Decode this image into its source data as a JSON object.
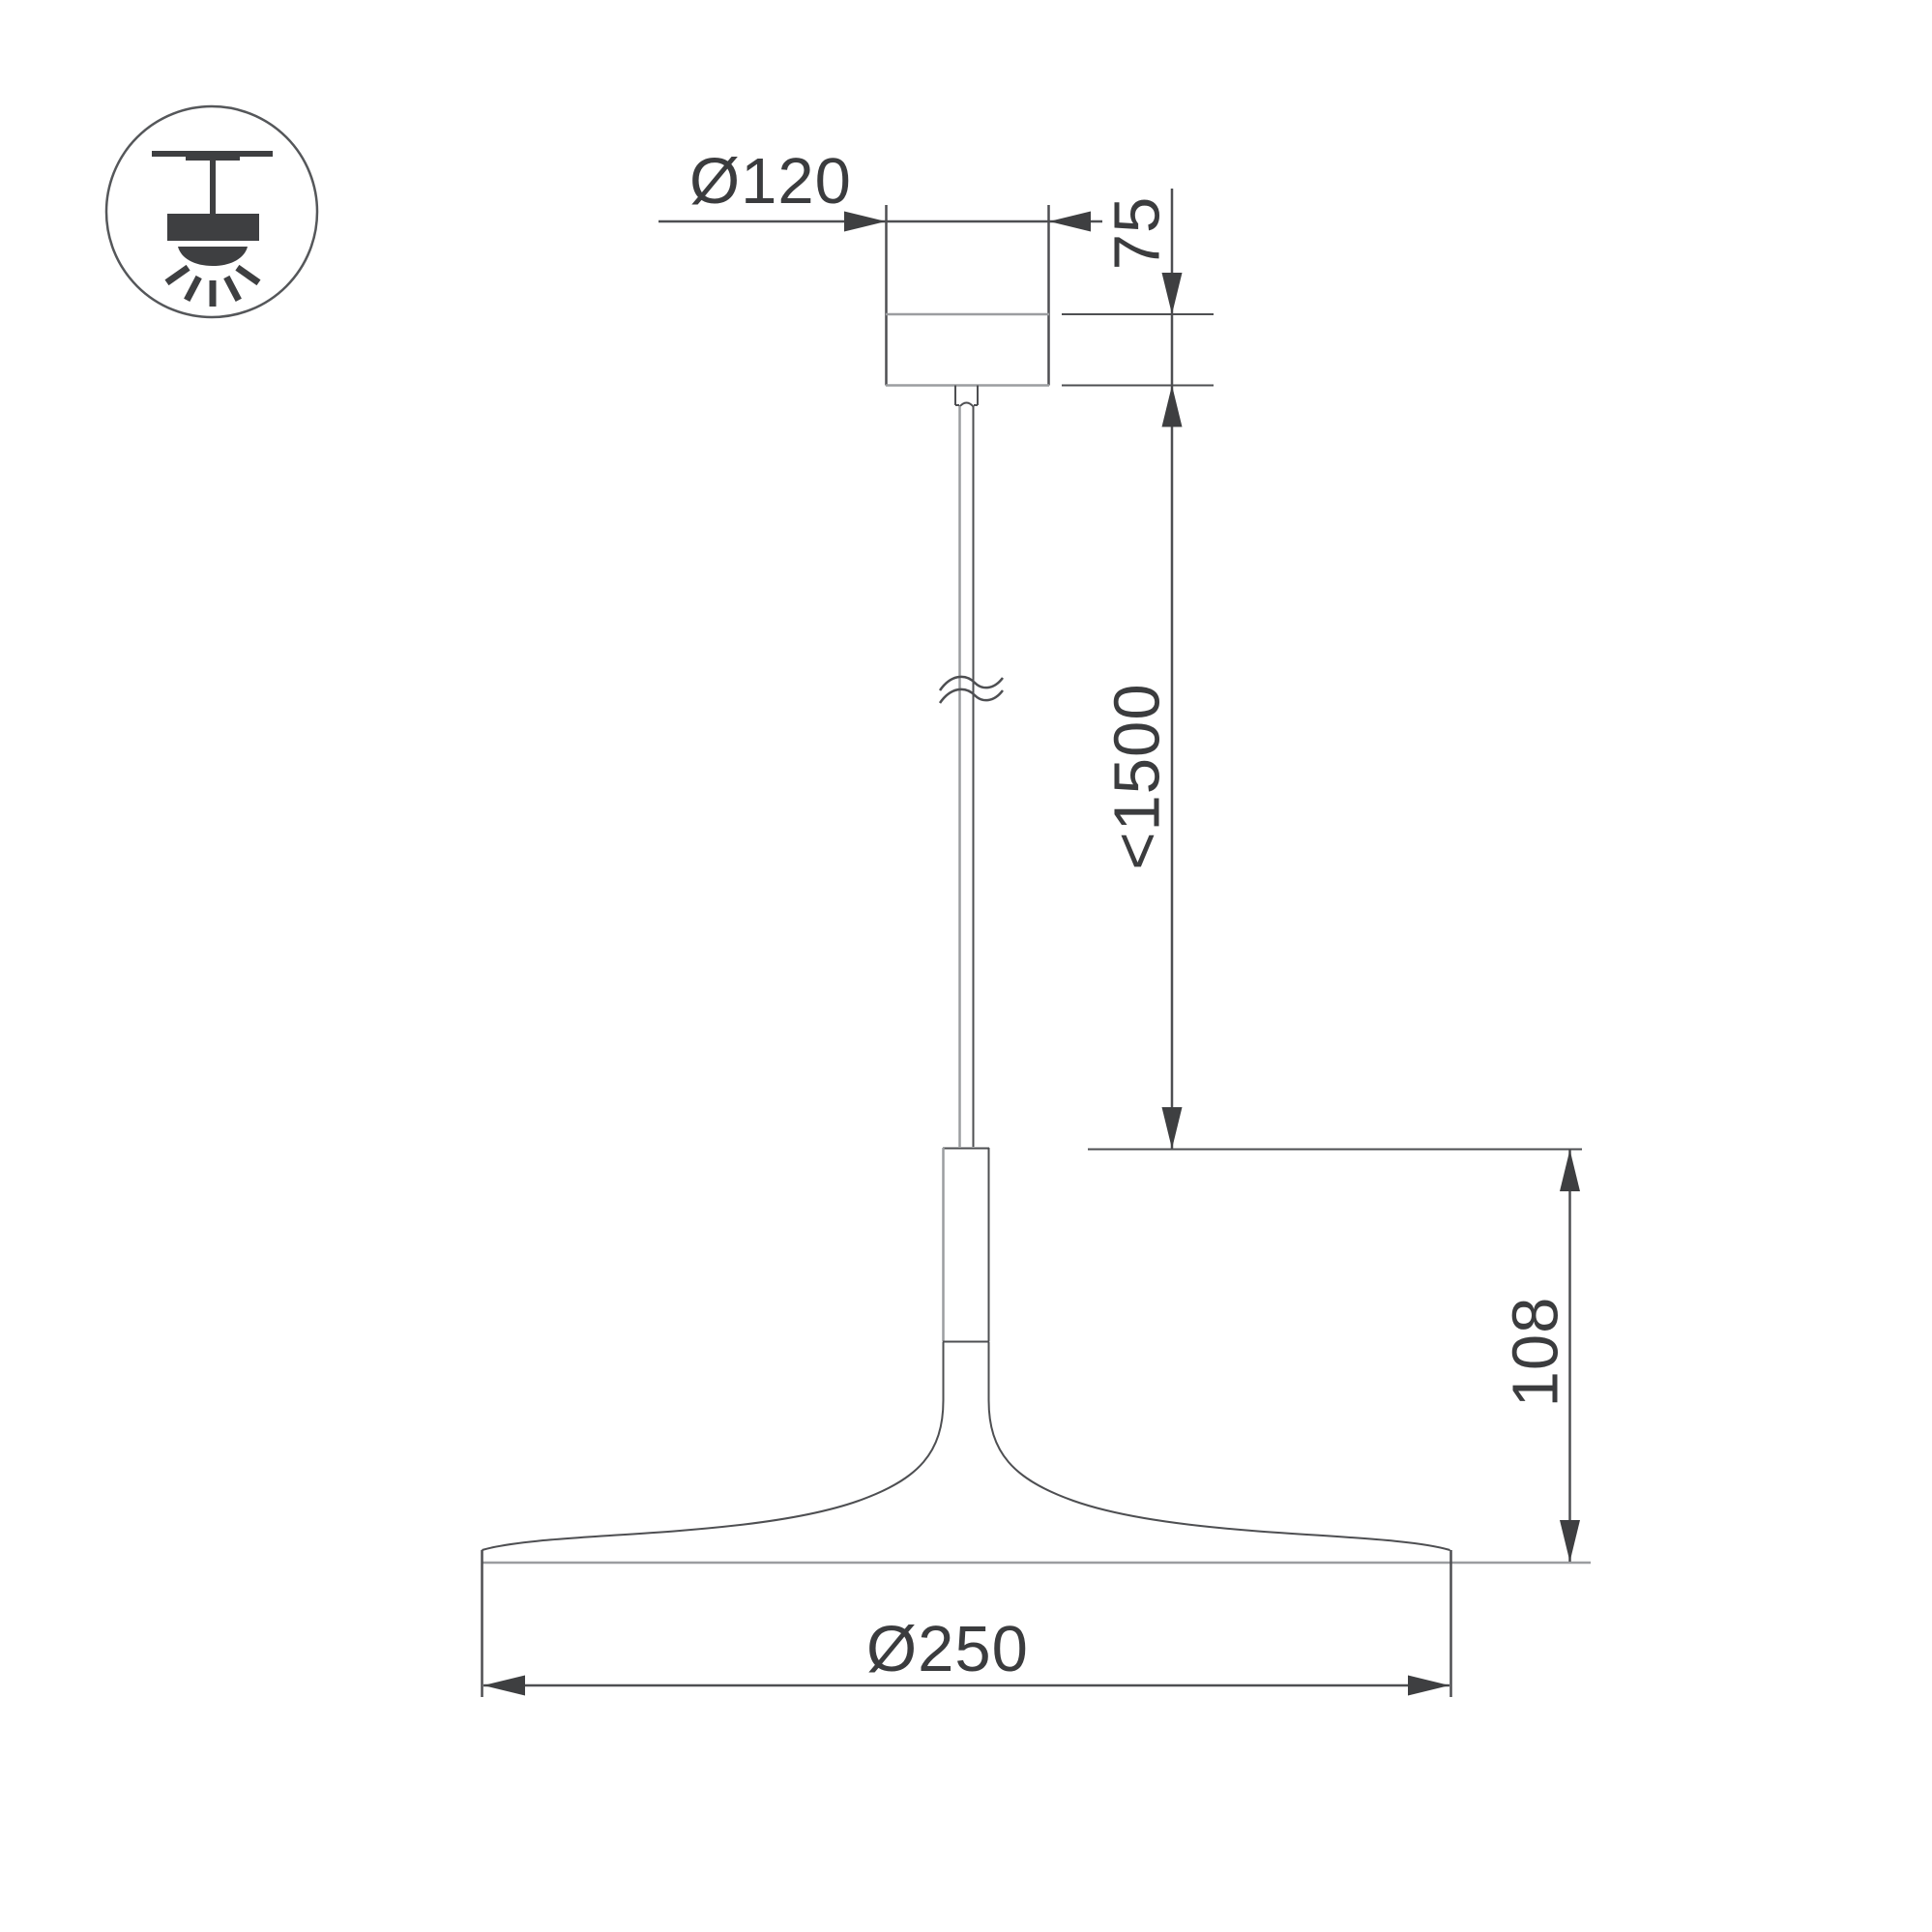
{
  "title": "Pendant luminaire dimension drawing",
  "colors": {
    "line_dark": "#4e4f52",
    "line_gray": "#9b9da0",
    "fill_dark": "#3e3f41",
    "text": "#3b3c3e",
    "bg": "#ffffff"
  },
  "icon": {
    "name": "ceiling-pendant-mount-icon"
  },
  "labels": {
    "canopy_diameter": "Ø120",
    "canopy_height": "75",
    "max_suspension": "<1500",
    "shade_height": "108",
    "shade_diameter": "Ø250"
  }
}
